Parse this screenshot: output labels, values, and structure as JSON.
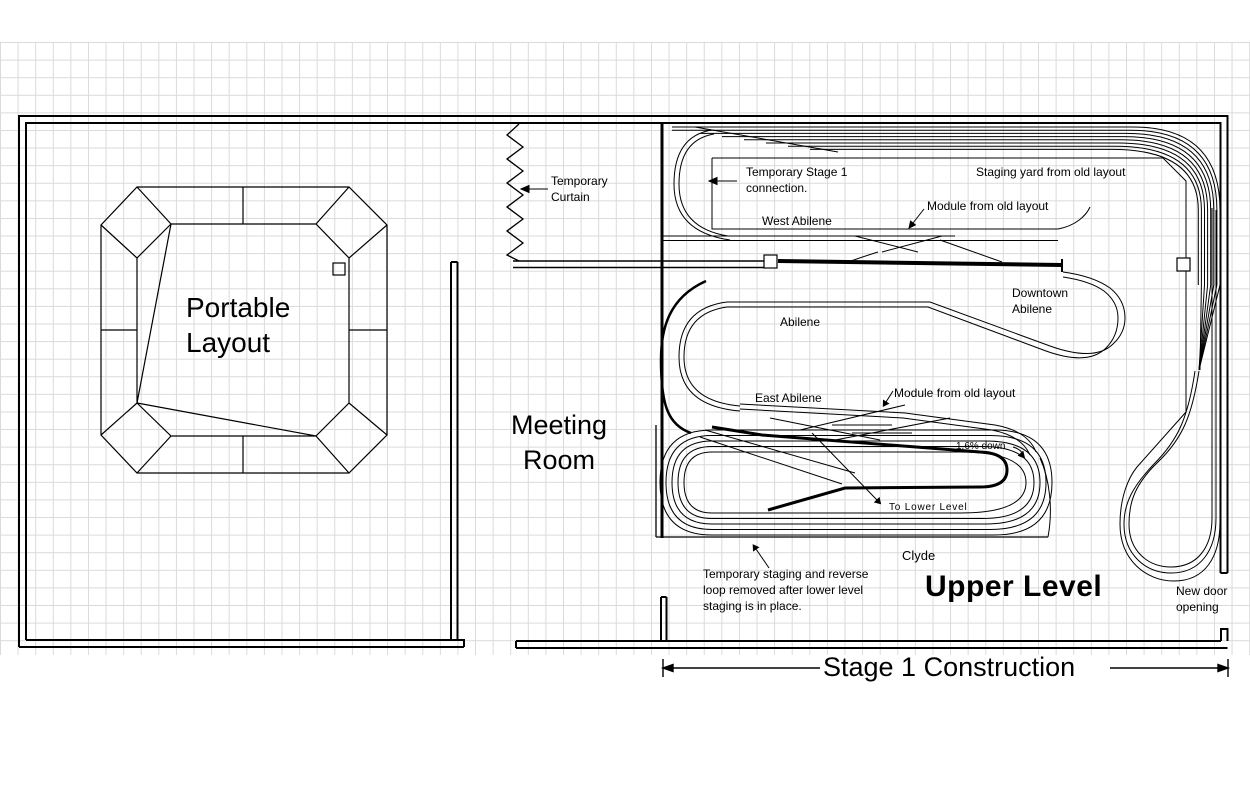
{
  "title": "Model railroad track plan - Stage 1 Construction (Upper Level)",
  "rooms": {
    "portable_layout": "Portable\nLayout",
    "meeting_room": "Meeting\nRoom",
    "upper_level": "Upper Level"
  },
  "dimension": {
    "stage1": "Stage 1 Construction"
  },
  "annotations": {
    "temporary_curtain": "Temporary\nCurtain",
    "temporary_stage1": "Temporary Stage 1\nconnection.",
    "west_abilene": "West Abilene",
    "staging_yard": "Staging yard from old layout",
    "module_from_old_layout_top": "Module from old layout",
    "downtown_abilene": "Downtown\nAbilene",
    "abilene": "Abilene",
    "east_abilene": "East Abilene",
    "module_from_old_layout_mid": "Module from old layout",
    "grade": "1.6% down",
    "to_lower_level": "To Lower Level",
    "clyde": "Clyde",
    "staging_note": "Temporary staging and reverse\nloop removed after lower level\nstaging is in place.",
    "new_door": "New door\nopening"
  },
  "colors": {
    "ink": "#000000",
    "grid": "#dadada",
    "background": "#ffffff"
  }
}
